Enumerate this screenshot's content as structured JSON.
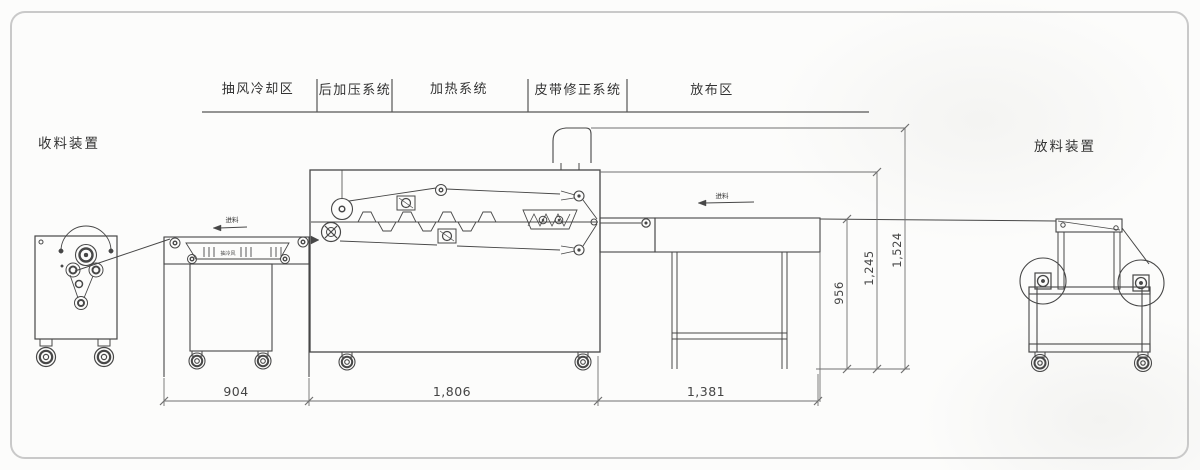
{
  "page": {
    "background": "#fcfcfb",
    "frame_color": "#c9c9c9",
    "line_color": "#474747",
    "dimension_color": "#707070",
    "text_color": "#333333"
  },
  "zone_header": {
    "items": [
      {
        "label": "抽风冷却区"
      },
      {
        "label": "后加压系统"
      },
      {
        "label": "加热系统"
      },
      {
        "label": "皮带修正系统"
      },
      {
        "label": "放布区"
      }
    ]
  },
  "devices": {
    "winder_label": "收料装置",
    "unwinder_label": "放料装置"
  },
  "dimensions": {
    "bottom": [
      "904",
      "1,806",
      "1,381"
    ],
    "vertical": [
      "956",
      "1,245",
      "1,524"
    ]
  },
  "annotations": {
    "feed_cooling": "进料",
    "feed_table": "进料",
    "vent": "抽冷风"
  }
}
